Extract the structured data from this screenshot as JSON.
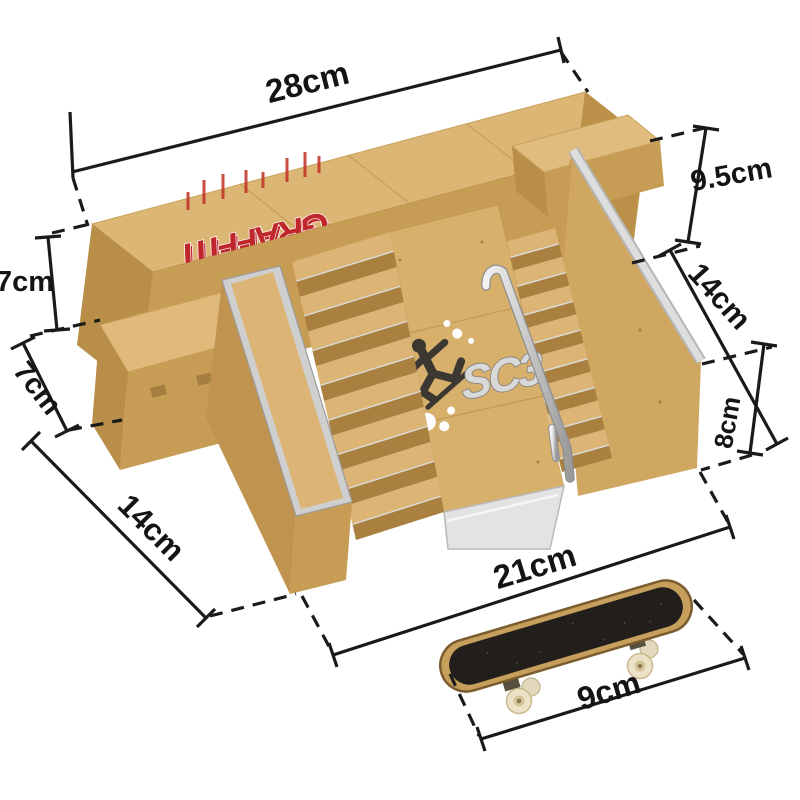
{
  "scene": {
    "background": "#ffffff",
    "units": "cm"
  },
  "dimensions": {
    "platform_width": {
      "label": "28cm"
    },
    "platform_height": {
      "label": "9.5cm"
    },
    "bank_length": {
      "label": "14cm"
    },
    "bank_height": {
      "label": "8cm"
    },
    "left_block_height": {
      "label": "7cm"
    },
    "left_block_depth": {
      "label": "7cm"
    },
    "stairs_depth": {
      "label": "14cm"
    },
    "base_width": {
      "label": "21cm"
    },
    "skateboard_length": {
      "label": "9cm"
    }
  },
  "decals": {
    "graffiti_text": "GRAFFITI",
    "logo_text": "SC3"
  },
  "colors": {
    "plastic_tan": "#dcb675",
    "plastic_light": "#e0bc7e",
    "plastic_shadow": "#c79c54",
    "plastic_dark": "#b88e49",
    "metal_silver": "#d6d6d6",
    "dimension_line": "#1a1a1a",
    "graffiti_red": "#bf272c",
    "griptape_black": "#211e1b",
    "deck_wood": "#c79f5d",
    "wheel_cream": "#ece2c8"
  }
}
